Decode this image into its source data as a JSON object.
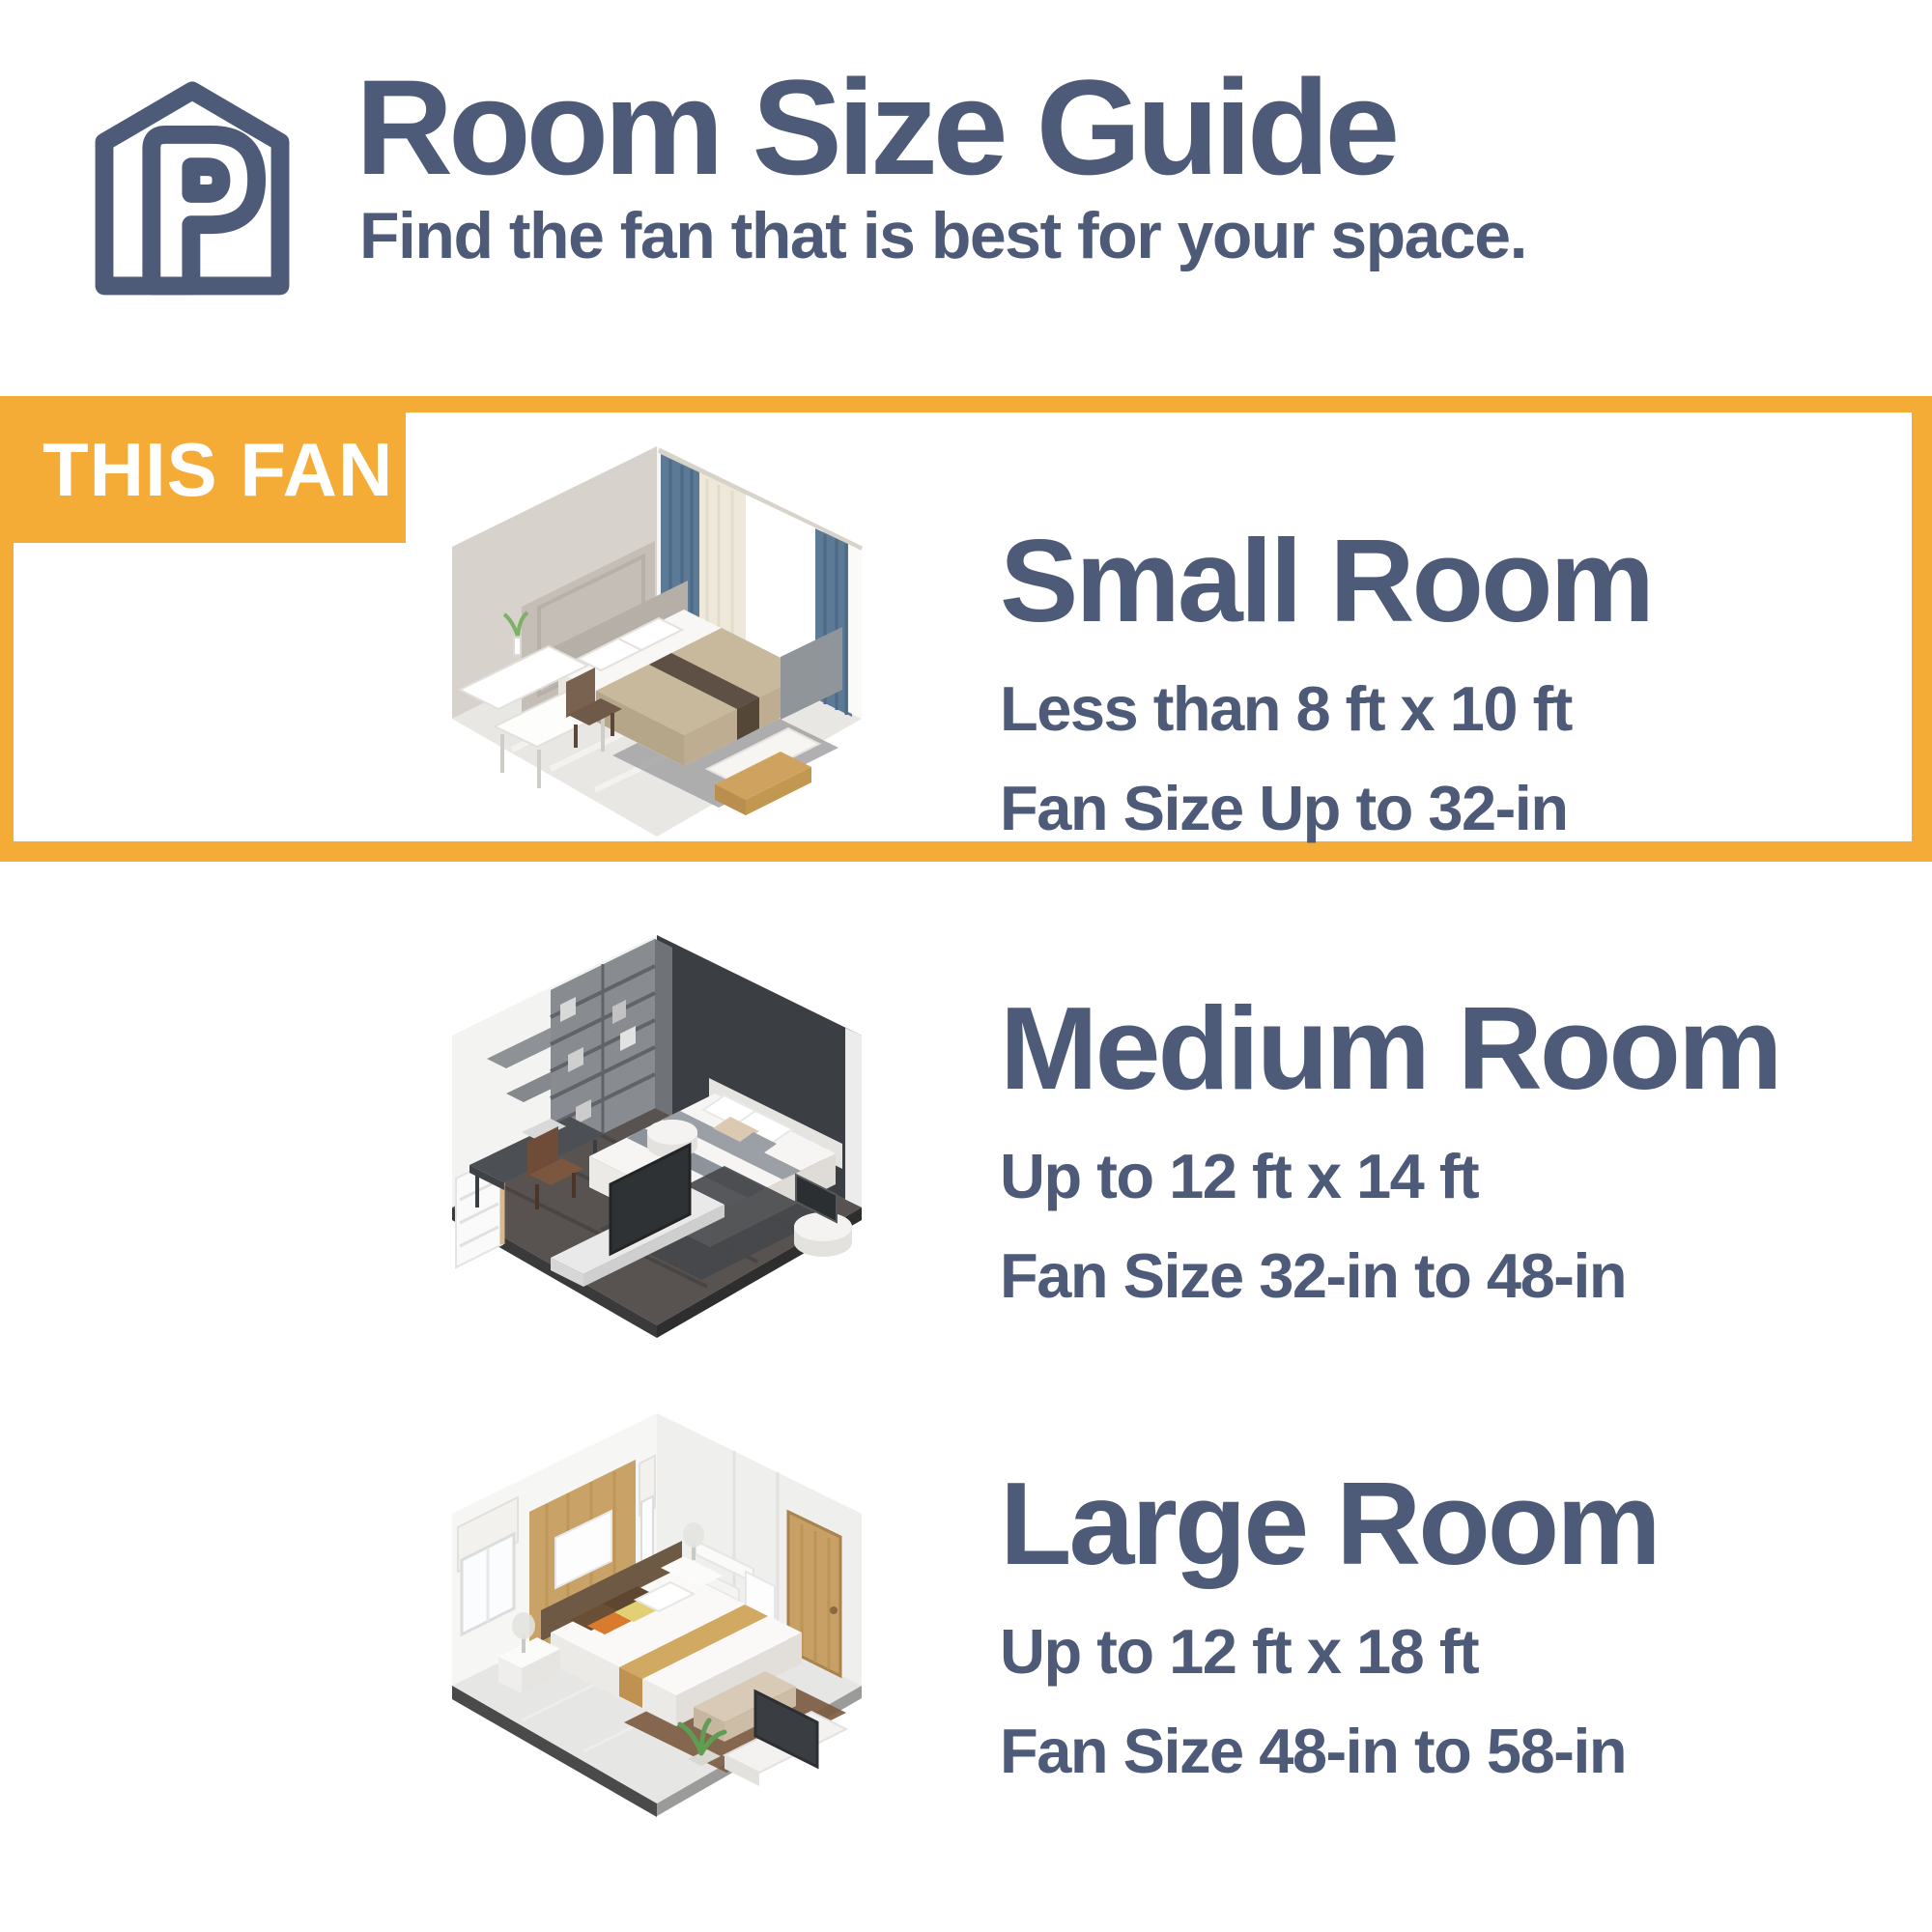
{
  "theme": {
    "accent_color": "#F4AC37",
    "ink_color": "#4D5A78",
    "background_color": "#FFFFFF"
  },
  "header": {
    "logo_icon": "house-p-brand-logo",
    "title": "Room Size Guide",
    "subtitle": "Find the fan that is best for your space."
  },
  "badge": {
    "label": "THIS FAN"
  },
  "sections": [
    {
      "id": "small-room",
      "highlighted": true,
      "illustration": "small-bedroom-isometric",
      "title": "Small Room",
      "dimensions": "Less than 8 ft x 10 ft",
      "fan_size": "Fan Size Up to 32-in"
    },
    {
      "id": "medium-room",
      "highlighted": false,
      "illustration": "medium-bedroom-isometric",
      "title": "Medium Room",
      "dimensions": "Up to 12 ft x 14 ft",
      "fan_size": "Fan Size 32-in to 48-in"
    },
    {
      "id": "large-room",
      "highlighted": false,
      "illustration": "large-bedroom-isometric",
      "title": "Large Room",
      "dimensions": "Up to 12 ft x 18 ft",
      "fan_size": "Fan Size 48-in to 58-in"
    }
  ]
}
